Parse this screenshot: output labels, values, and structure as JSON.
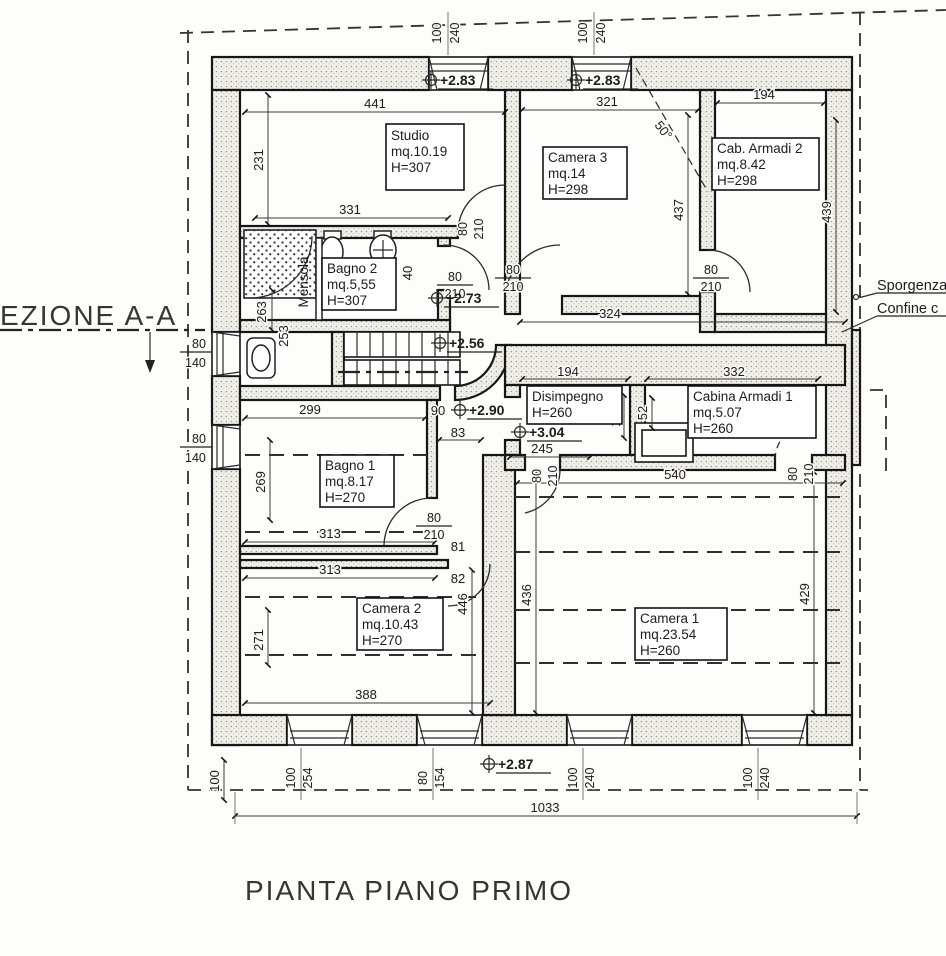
{
  "title": "PIANTA PIANO PRIMO",
  "section": {
    "label": "EZIONE A-A"
  },
  "boundary": {
    "sporgenza": "Sporgenza",
    "confine": "Confine c"
  },
  "door": {
    "w": "80",
    "h": "210"
  },
  "rooms": {
    "studio": {
      "name": "Studio",
      "area": "mq.10.19",
      "height": "H=307"
    },
    "camera3": {
      "name": "Camera 3",
      "area": "mq.14",
      "height": "H=298"
    },
    "cabarmadi2": {
      "name": "Cab. Armadi 2",
      "area": "mq.8.42",
      "height": "H=298"
    },
    "bagno2": {
      "name": "Bagno 2",
      "area": "mq.5,55",
      "height": "H=307"
    },
    "disimpegno": {
      "name": "Disimpegno",
      "height": "H=260"
    },
    "cabina1": {
      "name": "Cabina Armadi 1",
      "area": "mq.5.07",
      "height": "H=260"
    },
    "bagno1": {
      "name": "Bagno 1",
      "area": "mq.8.17",
      "height": "H=270"
    },
    "camera2": {
      "name": "Camera 2",
      "area": "mq.10.43",
      "height": "H=270"
    },
    "camera1": {
      "name": "Camera 1",
      "area": "mq.23.54",
      "height": "H=260"
    },
    "mensola": "Mensola"
  },
  "levels": {
    "a283": "+2.83",
    "b283": "+2.83",
    "v273": "+2.73",
    "v256": "+2.56",
    "v290": "+2.90",
    "v304": "+3.04",
    "v287": "+2.87"
  },
  "windows": {
    "top1": {
      "w": "100",
      "h": "240"
    },
    "top2": {
      "w": "100",
      "h": "240"
    },
    "left1": {
      "w": "80",
      "h": "140"
    },
    "left2": {
      "w": "80",
      "h": "140"
    },
    "b1": {
      "w": "100",
      "h": "254"
    },
    "b2": {
      "w": "80",
      "h": "154"
    },
    "b3": {
      "w": "100",
      "h": "240"
    },
    "b4": {
      "w": "100",
      "h": "240"
    }
  },
  "dims": {
    "d441": "441",
    "d231": "231",
    "d331": "331",
    "d321": "321",
    "d194top": "194",
    "d437": "437",
    "d439": "439",
    "d324": "324",
    "d263": "263",
    "d253": "253",
    "d40": "40",
    "d299": "299",
    "d269": "269",
    "d83": "83",
    "d81": "81",
    "d82": "82",
    "d313a": "313",
    "d313b": "313",
    "d388": "388",
    "d271": "271",
    "d446": "446",
    "d436": "436",
    "d429": "429",
    "d540": "540",
    "d194dis": "194",
    "d332": "332",
    "d152": "152",
    "d52": "52",
    "d245": "245",
    "d90": "90",
    "d100": "100",
    "d1033": "1033",
    "angle50": "50°"
  }
}
